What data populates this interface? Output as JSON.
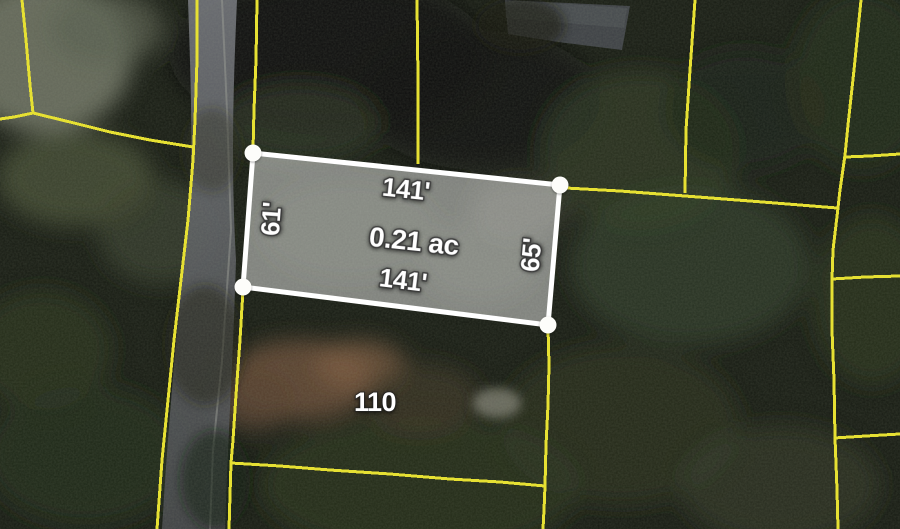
{
  "map": {
    "description": "aerial parcel map with selected lot highlighted",
    "selected_parcel": {
      "top_length": "141'",
      "bottom_length": "141'",
      "left_length": "61'",
      "right_length": "65'",
      "area": "0.21 ac"
    },
    "adjacent_lot_number": "110",
    "colors": {
      "parcel_boundary_yellow": "#e6e033",
      "selection_outline_white": "#ffffff",
      "selection_fill": "rgba(255,255,255,0.45)",
      "label_text": "#ffffff",
      "road_gray": "#66686c",
      "forest_dark": "#1a1f15",
      "dirt_brown": "#6a4e38",
      "roof_gray": "#3d4045"
    }
  }
}
